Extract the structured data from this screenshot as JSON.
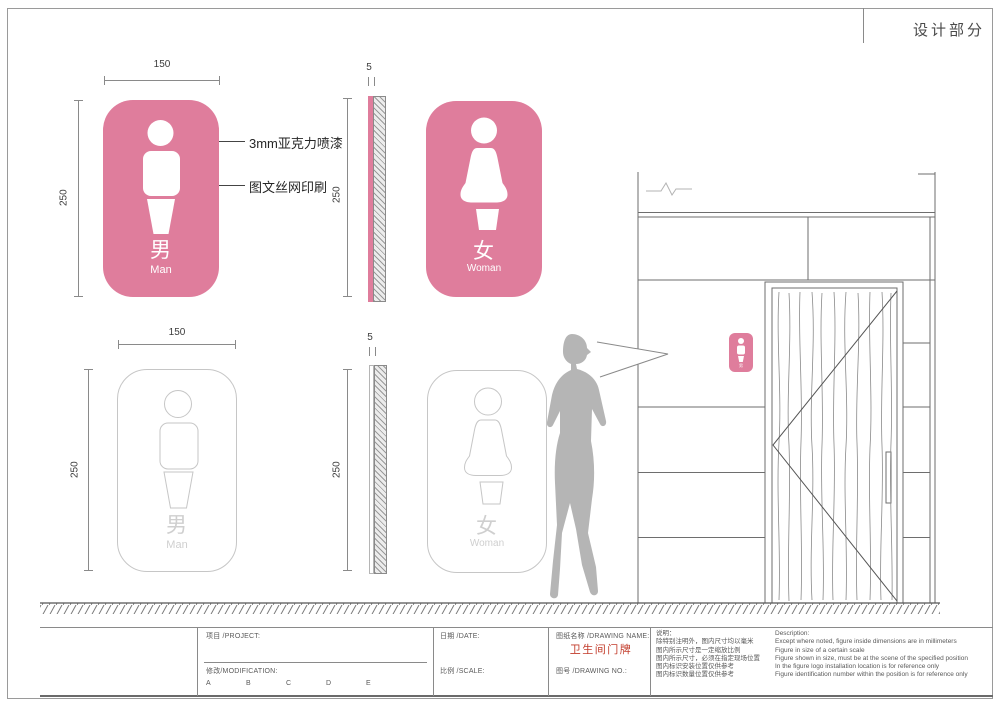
{
  "page": {
    "header_title": "设计部分"
  },
  "colors": {
    "sign_pink": "#df7d9c",
    "drawing_name_red": "#c23b2a",
    "outline_gray": "#c6c6c6",
    "line_gray": "#8a8a8a",
    "silhouette_gray": "#b5b5b5"
  },
  "dims": {
    "sign_width": "150",
    "sign_height": "250",
    "sign_thickness": "5"
  },
  "callouts": {
    "material": "3mm亚克力喷漆",
    "print": "图文丝网印刷"
  },
  "signs": {
    "man": {
      "cn": "男",
      "en": "Man"
    },
    "woman": {
      "cn": "女",
      "en": "Woman"
    }
  },
  "titleblock": {
    "project_label": "项目 /PROJECT:",
    "modification_label": "修改/MODIFICATION:",
    "revisions": [
      "A",
      "B",
      "C",
      "D",
      "E"
    ],
    "date_label": "日期 /DATE:",
    "scale_label": "比例 /SCALE:",
    "drawing_name_label": "图纸名称 /DRAWING NAME:",
    "drawing_name": "卫生间门牌",
    "drawing_no_label": "图号 /DRAWING NO.:",
    "notes_cn_title": "说明：",
    "notes_cn": [
      "除特别注明外，图内尺寸均以毫米",
      "图内所示尺寸是一定缩放比例",
      "图内所示尺寸，必须在指定现场位置",
      "图内标识安装位置仅供参考",
      "图内标识数量位置仅供参考"
    ],
    "notes_en_title": "Description:",
    "notes_en": [
      "Except where noted, figure inside dimensions are in millimeters",
      "Figure in size of a certain scale",
      "Figure shown in size, must be at the scene of the specified position",
      "In the figure logo installation location is for reference only",
      "Figure identification number within the position is for reference only"
    ]
  }
}
